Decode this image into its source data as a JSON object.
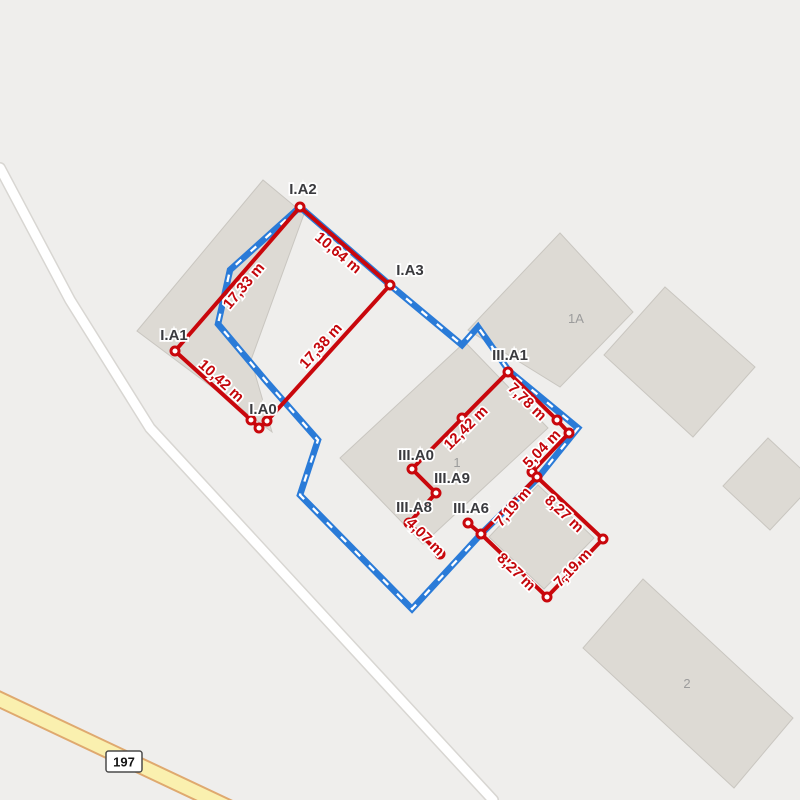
{
  "map": {
    "colors": {
      "background": "#EFEEEC",
      "building_fill": "#DDDAD4",
      "building_stroke": "#C9C6C0",
      "boundary_blue": "#2A7BD8",
      "boundary_dash_white": "#FFFFFF",
      "measure_red": "#C9070C",
      "point_fill": "#FFFFFF",
      "road_white_fill": "#FFFFFF",
      "road_white_casing": "#D8D6D2",
      "road_yellow_fill": "#FAF0AF",
      "road_yellow_casing": "#DFA96F"
    },
    "roads": {
      "minor_road": {
        "points": [
          [
            0,
            168
          ],
          [
            70,
            300
          ],
          [
            150,
            428
          ],
          [
            493,
            800
          ]
        ]
      },
      "highway": {
        "ref": "197",
        "points": [
          [
            -12,
            694
          ],
          [
            232,
            809
          ]
        ],
        "badge": {
          "x": 124,
          "y": 762
        }
      }
    },
    "buildings": [
      {
        "id": "building-a",
        "label": "",
        "points": [
          [
            137,
            331
          ],
          [
            263,
            180
          ],
          [
            304,
            214
          ],
          [
            251,
            360
          ],
          [
            272,
            432
          ]
        ],
        "label_pos": null
      },
      {
        "id": "building-1a",
        "label": "1A",
        "points": [
          [
            560,
            233
          ],
          [
            633,
            312
          ],
          [
            560,
            387
          ],
          [
            468,
            330
          ]
        ],
        "label_pos": [
          576,
          323
        ]
      },
      {
        "id": "building-ne",
        "label": "",
        "points": [
          [
            665,
            287
          ],
          [
            755,
            367
          ],
          [
            693,
            437
          ],
          [
            604,
            355
          ]
        ],
        "label_pos": null
      },
      {
        "id": "building-1",
        "label": "1",
        "points": [
          [
            340,
            458
          ],
          [
            465,
            342
          ],
          [
            548,
            428
          ],
          [
            423,
            544
          ]
        ],
        "label_pos": [
          457,
          467
        ]
      },
      {
        "id": "building-c",
        "label": "",
        "points": [
          [
            538,
            485
          ],
          [
            594,
            538
          ],
          [
            544,
            589
          ],
          [
            489,
            537
          ]
        ],
        "label_pos": null
      },
      {
        "id": "building-e",
        "label": "",
        "points": [
          [
            768,
            438
          ],
          [
            815,
            482
          ],
          [
            770,
            530
          ],
          [
            723,
            486
          ]
        ],
        "label_pos": null
      },
      {
        "id": "building-2",
        "label": "2",
        "points": [
          [
            643,
            579
          ],
          [
            793,
            718
          ],
          [
            734,
            788
          ],
          [
            583,
            648
          ]
        ],
        "label_pos": [
          687,
          688
        ]
      }
    ],
    "parcel_boundary": {
      "points": [
        [
          300,
          207
        ],
        [
          390,
          285
        ],
        [
          462,
          345
        ],
        [
          478,
          327
        ],
        [
          509,
          371
        ],
        [
          578,
          428
        ],
        [
          537,
          479
        ],
        [
          481,
          534
        ],
        [
          412,
          609
        ],
        [
          300,
          495
        ],
        [
          318,
          440
        ],
        [
          266,
          381
        ],
        [
          218,
          324
        ],
        [
          230,
          270
        ]
      ]
    },
    "measurements": {
      "paths": [
        {
          "id": "outline-I",
          "d": "M175,351 L300,207 L390,285 L267,421 L259,428 L251,420 Z"
        },
        {
          "id": "outline-III-west",
          "d": "M508,372 L412,469 L436,493 L409,523 L440,554"
        },
        {
          "id": "outline-III-east",
          "d": "M508,372 L557,420 L569,433 L532,472 L537,477"
        },
        {
          "id": "outline-III-annex",
          "d": "M537,477 L603,539 L547,597 L481,534 Z"
        },
        {
          "id": "outline-III-a6",
          "d": "M481,534 L468,523"
        }
      ],
      "points": [
        {
          "label": "I.A1",
          "x": 175,
          "y": 351
        },
        {
          "label": "I.A2",
          "x": 300,
          "y": 207
        },
        {
          "label": "I.A3",
          "x": 390,
          "y": 285
        },
        {
          "label": "",
          "x": 267,
          "y": 421
        },
        {
          "label": "I.A0",
          "x": 259,
          "y": 428
        },
        {
          "label": "",
          "x": 251,
          "y": 420
        },
        {
          "label": "III.A1",
          "x": 508,
          "y": 372
        },
        {
          "label": "",
          "x": 462,
          "y": 418
        },
        {
          "label": "III.A0",
          "x": 412,
          "y": 469
        },
        {
          "label": "III.A9",
          "x": 436,
          "y": 493
        },
        {
          "label": "III.A8",
          "x": 409,
          "y": 523
        },
        {
          "label": "",
          "x": 440,
          "y": 554
        },
        {
          "label": "",
          "x": 557,
          "y": 420
        },
        {
          "label": "",
          "x": 569,
          "y": 433
        },
        {
          "label": "",
          "x": 532,
          "y": 472
        },
        {
          "label": "",
          "x": 537,
          "y": 477
        },
        {
          "label": "",
          "x": 603,
          "y": 539
        },
        {
          "label": "",
          "x": 547,
          "y": 597
        },
        {
          "label": "",
          "x": 481,
          "y": 534
        },
        {
          "label": "III.A6",
          "x": 468,
          "y": 523
        }
      ],
      "point_labels": [
        {
          "text": "I.A2",
          "x": 303,
          "y": 194
        },
        {
          "text": "I.A3",
          "x": 410,
          "y": 275
        },
        {
          "text": "I.A1",
          "x": 174,
          "y": 340
        },
        {
          "text": "I.A0",
          "x": 263,
          "y": 414
        },
        {
          "text": "III.A1",
          "x": 510,
          "y": 360
        },
        {
          "text": "III.A0",
          "x": 416,
          "y": 460
        },
        {
          "text": "III.A9",
          "x": 452,
          "y": 483
        },
        {
          "text": "III.A8",
          "x": 414,
          "y": 512
        },
        {
          "text": "III.A6",
          "x": 471,
          "y": 513
        }
      ],
      "distance_labels": [
        {
          "text": "17,33 m",
          "x": 244,
          "y": 286,
          "angle": -50
        },
        {
          "text": "10,64 m",
          "x": 338,
          "y": 253,
          "angle": 40
        },
        {
          "text": "17,38 m",
          "x": 321,
          "y": 346,
          "angle": -48
        },
        {
          "text": "10,42 m",
          "x": 221,
          "y": 381,
          "angle": 42
        },
        {
          "text": "12,42 m",
          "x": 466,
          "y": 428,
          "angle": -45
        },
        {
          "text": "7,78 m",
          "x": 527,
          "y": 402,
          "angle": 44
        },
        {
          "text": "5,04 m",
          "x": 542,
          "y": 449,
          "angle": -46
        },
        {
          "text": "4,07 m",
          "x": 425,
          "y": 537,
          "angle": 45
        },
        {
          "text": "7,19 m",
          "x": 513,
          "y": 507,
          "angle": -49
        },
        {
          "text": "8,27 m",
          "x": 564,
          "y": 514,
          "angle": 43
        },
        {
          "text": "8,27 m",
          "x": 516,
          "y": 572,
          "angle": 44
        },
        {
          "text": "7,19 m",
          "x": 573,
          "y": 568,
          "angle": -46
        }
      ]
    }
  }
}
